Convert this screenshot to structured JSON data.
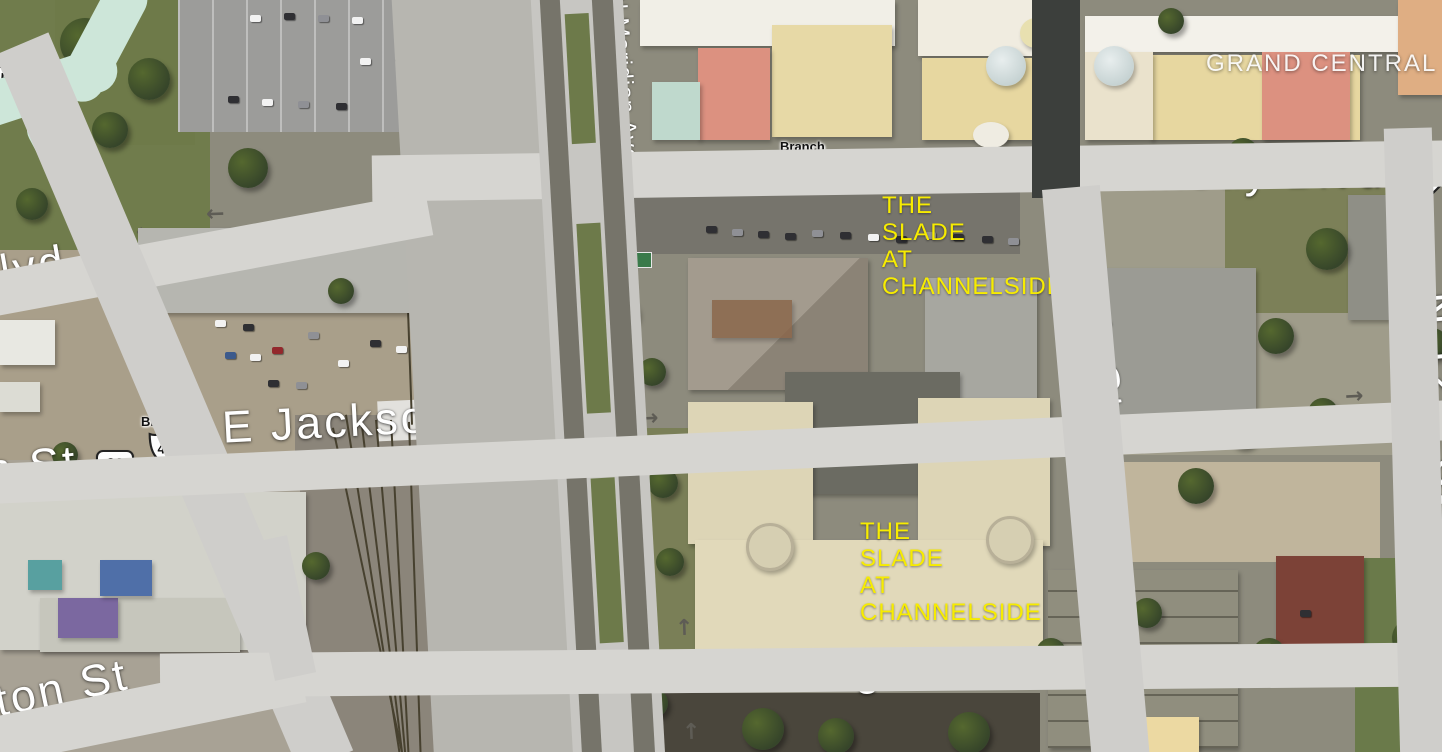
{
  "map": {
    "streets": {
      "kennedy": "E John F Kennedy Blvd",
      "jackson": "E Jackson St",
      "washington": "E Washington St",
      "eleventh": "N 11th St",
      "twelfth": "N 12th St",
      "meridian": "N Meridian Ave",
      "nebraska": "N Nebraska Ave",
      "partial_blvd": "lvd",
      "partial_n_st": "n St",
      "partial_ton_st": "ton St",
      "partial_n": "N"
    },
    "places": {
      "grand_central": "GRAND CENTRAL",
      "slade_upper": "THE\nSLADE\nAT\nCHANNELSIDE",
      "slade_lower": "THE\nSLADE\nAT\nCHANNELSIDE"
    },
    "shields": {
      "kennedy_60": "60",
      "kennedy_45": "45",
      "kennedy_41": "41",
      "kennedy_branch": "Branch",
      "right_41": "41",
      "right_branch": "Branch",
      "jackson_60": "60",
      "jackson_41": "41",
      "jackson_branch": "Branch",
      "left_partial": "5"
    },
    "icons": {
      "road_arrow": "→"
    },
    "colors": {
      "label_white": "#ffffff",
      "label_yellow": "#f7ec00",
      "road_gray": "#d6d5d1",
      "ramp_teal": "#cde6d9",
      "shield_text": "#111111"
    }
  }
}
